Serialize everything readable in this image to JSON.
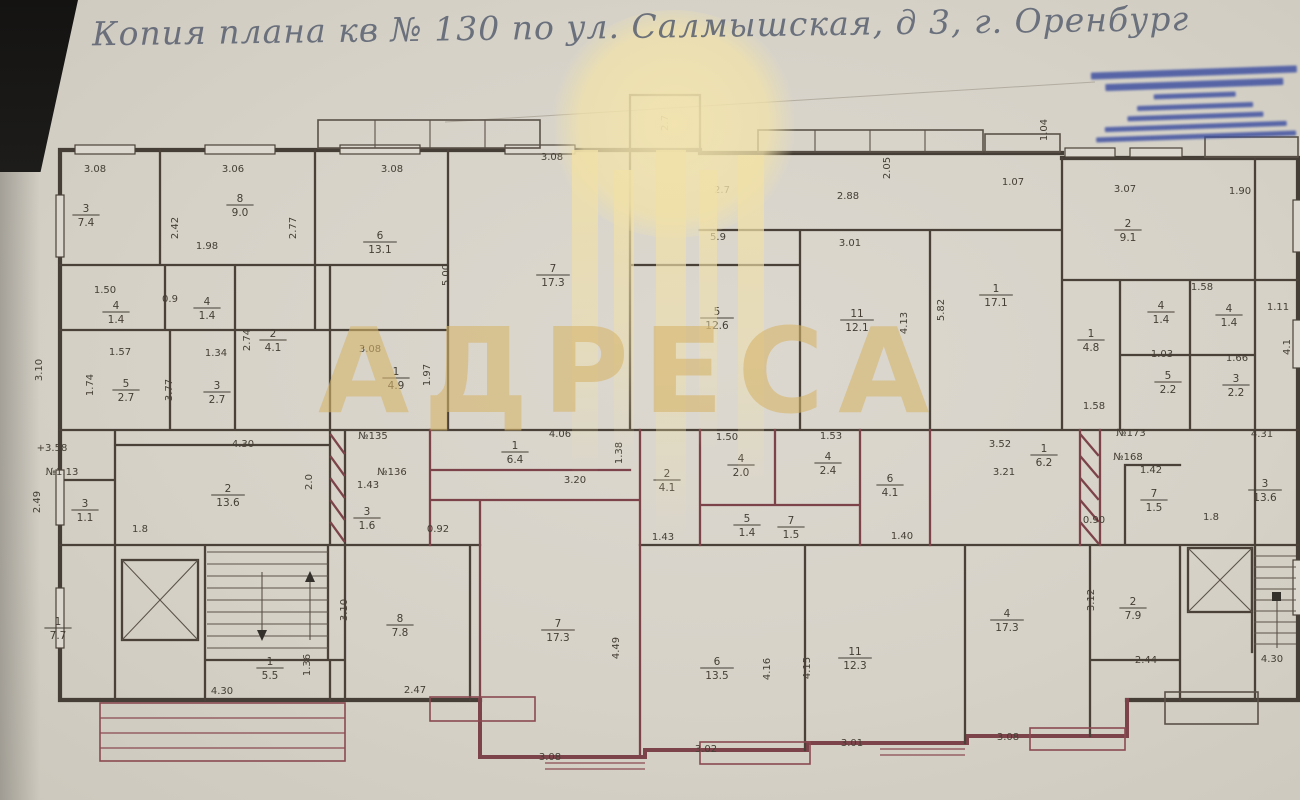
{
  "title": {
    "text": "Копия плана кв № 130 по ул. Салмышская, д 3, г. Оренбург"
  },
  "watermark": {
    "brand": "АДРЕСА",
    "color": "#d6b46a"
  },
  "stamp": {
    "ink_color": "#3b4da0",
    "line_widths_pct": [
      100,
      86,
      40,
      56,
      66,
      88,
      97
    ]
  },
  "plan": {
    "labels": [
      {
        "x": 95,
        "y": 172,
        "t": "3.08"
      },
      {
        "x": 233,
        "y": 172,
        "t": "3.06"
      },
      {
        "x": 392,
        "y": 172,
        "t": "3.08"
      },
      {
        "x": 552,
        "y": 160,
        "t": "3.08"
      },
      {
        "x": 722,
        "y": 193,
        "t": "2.7"
      },
      {
        "x": 848,
        "y": 199,
        "t": "2.88"
      },
      {
        "x": 1013,
        "y": 185,
        "t": "1.07"
      },
      {
        "x": 1125,
        "y": 192,
        "t": "3.07"
      },
      {
        "x": 1240,
        "y": 194,
        "t": "1.90"
      },
      {
        "x": 207,
        "y": 249,
        "t": "1.98"
      },
      {
        "x": 105,
        "y": 293,
        "t": "1.50"
      },
      {
        "x": 170,
        "y": 302,
        "t": "0.9"
      },
      {
        "x": 120,
        "y": 355,
        "t": "1.57"
      },
      {
        "x": 216,
        "y": 356,
        "t": "1.34"
      },
      {
        "x": 370,
        "y": 352,
        "t": "3.08"
      },
      {
        "x": 718,
        "y": 240,
        "t": "5.9"
      },
      {
        "x": 850,
        "y": 246,
        "t": "3.01"
      },
      {
        "x": 1202,
        "y": 290,
        "t": "1.58"
      },
      {
        "x": 1162,
        "y": 357,
        "t": "1.03"
      },
      {
        "x": 1237,
        "y": 361,
        "t": "1.66"
      },
      {
        "x": 1094,
        "y": 409,
        "t": "1.58"
      },
      {
        "x": 1278,
        "y": 310,
        "t": "1.11"
      },
      {
        "x": 243,
        "y": 447,
        "t": "4.30"
      },
      {
        "x": 52,
        "y": 451,
        "t": "+3.58"
      },
      {
        "x": 62,
        "y": 475,
        "t": "№1.13"
      },
      {
        "x": 373,
        "y": 439,
        "t": "№135"
      },
      {
        "x": 392,
        "y": 475,
        "t": "№136"
      },
      {
        "x": 368,
        "y": 488,
        "t": "1.43"
      },
      {
        "x": 438,
        "y": 532,
        "t": "0.92"
      },
      {
        "x": 575,
        "y": 483,
        "t": "3.20"
      },
      {
        "x": 560,
        "y": 437,
        "t": "4.06"
      },
      {
        "x": 727,
        "y": 440,
        "t": "1.50"
      },
      {
        "x": 831,
        "y": 439,
        "t": "1.53"
      },
      {
        "x": 663,
        "y": 540,
        "t": "1.43"
      },
      {
        "x": 902,
        "y": 539,
        "t": "1.40"
      },
      {
        "x": 1000,
        "y": 447,
        "t": "3.52"
      },
      {
        "x": 1131,
        "y": 436,
        "t": "№173"
      },
      {
        "x": 1262,
        "y": 437,
        "t": "4.31"
      },
      {
        "x": 1128,
        "y": 460,
        "t": "№168"
      },
      {
        "x": 1151,
        "y": 473,
        "t": "1.42"
      },
      {
        "x": 1004,
        "y": 475,
        "t": "3.21"
      },
      {
        "x": 1094,
        "y": 523,
        "t": "0.90"
      },
      {
        "x": 1211,
        "y": 520,
        "t": "1.8"
      },
      {
        "x": 140,
        "y": 532,
        "t": "1.8"
      },
      {
        "x": 222,
        "y": 694,
        "t": "4.30"
      },
      {
        "x": 415,
        "y": 693,
        "t": "2.47"
      },
      {
        "x": 1146,
        "y": 663,
        "t": "2.44"
      },
      {
        "x": 1272,
        "y": 662,
        "t": "4.30"
      },
      {
        "x": 550,
        "y": 760,
        "t": "3.08"
      },
      {
        "x": 706,
        "y": 752,
        "t": "3.02"
      },
      {
        "x": 852,
        "y": 746,
        "t": "3.01"
      },
      {
        "x": 1008,
        "y": 740,
        "t": "3.08"
      },
      {
        "x": 178,
        "y": 228,
        "t": "2.42",
        "r": 1
      },
      {
        "x": 296,
        "y": 228,
        "t": "2.77",
        "r": 1
      },
      {
        "x": 449,
        "y": 275,
        "t": "5.00",
        "r": 1
      },
      {
        "x": 890,
        "y": 168,
        "t": "2.05",
        "r": 1
      },
      {
        "x": 907,
        "y": 323,
        "t": "4.13",
        "r": 1
      },
      {
        "x": 944,
        "y": 310,
        "t": "5.82",
        "r": 1
      },
      {
        "x": 42,
        "y": 370,
        "t": "3.10",
        "r": 1
      },
      {
        "x": 93,
        "y": 385,
        "t": "1.74",
        "r": 1
      },
      {
        "x": 172,
        "y": 390,
        "t": "3.77",
        "r": 1
      },
      {
        "x": 250,
        "y": 340,
        "t": "2.74",
        "r": 1
      },
      {
        "x": 430,
        "y": 375,
        "t": "1.97",
        "r": 1
      },
      {
        "x": 312,
        "y": 482,
        "t": "2.0",
        "r": 1
      },
      {
        "x": 40,
        "y": 502,
        "t": "2.49",
        "r": 1
      },
      {
        "x": 622,
        "y": 453,
        "t": "1.38",
        "r": 1
      },
      {
        "x": 347,
        "y": 610,
        "t": "3.10",
        "r": 1
      },
      {
        "x": 310,
        "y": 665,
        "t": "1.36",
        "r": 1
      },
      {
        "x": 619,
        "y": 648,
        "t": "4.49",
        "r": 1
      },
      {
        "x": 770,
        "y": 669,
        "t": "4.16",
        "r": 1
      },
      {
        "x": 810,
        "y": 668,
        "t": "4.15",
        "r": 1
      },
      {
        "x": 1094,
        "y": 600,
        "t": "3.12",
        "r": 1
      },
      {
        "x": 668,
        "y": 123,
        "t": "2.7",
        "r": 1
      },
      {
        "x": 1290,
        "y": 347,
        "t": "4.1",
        "r": 1
      },
      {
        "x": 1047,
        "y": 130,
        "t": "1.04",
        "r": 1
      },
      {
        "x": 86,
        "y": 215,
        "n": "3",
        "d": "7.4"
      },
      {
        "x": 240,
        "y": 205,
        "n": "8",
        "d": "9.0"
      },
      {
        "x": 380,
        "y": 242,
        "n": "6",
        "d": "13.1"
      },
      {
        "x": 553,
        "y": 275,
        "n": "7",
        "d": "17.3"
      },
      {
        "x": 717,
        "y": 318,
        "n": "5",
        "d": "12.6"
      },
      {
        "x": 857,
        "y": 320,
        "n": "11",
        "d": "12.1"
      },
      {
        "x": 996,
        "y": 295,
        "n": "1",
        "d": "17.1"
      },
      {
        "x": 1128,
        "y": 230,
        "n": "2",
        "d": "9.1"
      },
      {
        "x": 1161,
        "y": 312,
        "n": "4",
        "d": "1.4"
      },
      {
        "x": 1229,
        "y": 315,
        "n": "4",
        "d": "1.4"
      },
      {
        "x": 1168,
        "y": 382,
        "n": "5",
        "d": "2.2"
      },
      {
        "x": 1236,
        "y": 385,
        "n": "3",
        "d": "2.2"
      },
      {
        "x": 1091,
        "y": 340,
        "n": "1",
        "d": "4.8"
      },
      {
        "x": 116,
        "y": 312,
        "n": "4",
        "d": "1.4"
      },
      {
        "x": 207,
        "y": 308,
        "n": "4",
        "d": "1.4"
      },
      {
        "x": 126,
        "y": 390,
        "n": "5",
        "d": "2.7"
      },
      {
        "x": 217,
        "y": 392,
        "n": "3",
        "d": "2.7"
      },
      {
        "x": 273,
        "y": 340,
        "n": "2",
        "d": "4.1"
      },
      {
        "x": 396,
        "y": 378,
        "n": "1",
        "d": "4.9"
      },
      {
        "x": 228,
        "y": 495,
        "n": "2",
        "d": "13.6"
      },
      {
        "x": 85,
        "y": 510,
        "n": "3",
        "d": "1.1"
      },
      {
        "x": 367,
        "y": 518,
        "n": "3",
        "d": "1.6"
      },
      {
        "x": 515,
        "y": 452,
        "n": "1",
        "d": "6.4"
      },
      {
        "x": 667,
        "y": 480,
        "n": "2",
        "d": "4.1"
      },
      {
        "x": 741,
        "y": 465,
        "n": "4",
        "d": "2.0"
      },
      {
        "x": 828,
        "y": 463,
        "n": "4",
        "d": "2.4"
      },
      {
        "x": 890,
        "y": 485,
        "n": "6",
        "d": "4.1"
      },
      {
        "x": 747,
        "y": 525,
        "n": "5",
        "d": "1.4"
      },
      {
        "x": 791,
        "y": 527,
        "n": "7",
        "d": "1.5"
      },
      {
        "x": 1044,
        "y": 455,
        "n": "1",
        "d": "6.2"
      },
      {
        "x": 1154,
        "y": 500,
        "n": "7",
        "d": "1.5"
      },
      {
        "x": 1265,
        "y": 490,
        "n": "3",
        "d": "13.6"
      },
      {
        "x": 58,
        "y": 628,
        "n": "1",
        "d": "7.7"
      },
      {
        "x": 270,
        "y": 668,
        "n": "1",
        "d": "5.5"
      },
      {
        "x": 400,
        "y": 625,
        "n": "8",
        "d": "7.8"
      },
      {
        "x": 558,
        "y": 630,
        "n": "7",
        "d": "17.3"
      },
      {
        "x": 717,
        "y": 668,
        "n": "6",
        "d": "13.5"
      },
      {
        "x": 855,
        "y": 658,
        "n": "11",
        "d": "12.3"
      },
      {
        "x": 1007,
        "y": 620,
        "n": "4",
        "d": "17.3"
      },
      {
        "x": 1133,
        "y": 608,
        "n": "2",
        "d": "7.9"
      }
    ]
  }
}
